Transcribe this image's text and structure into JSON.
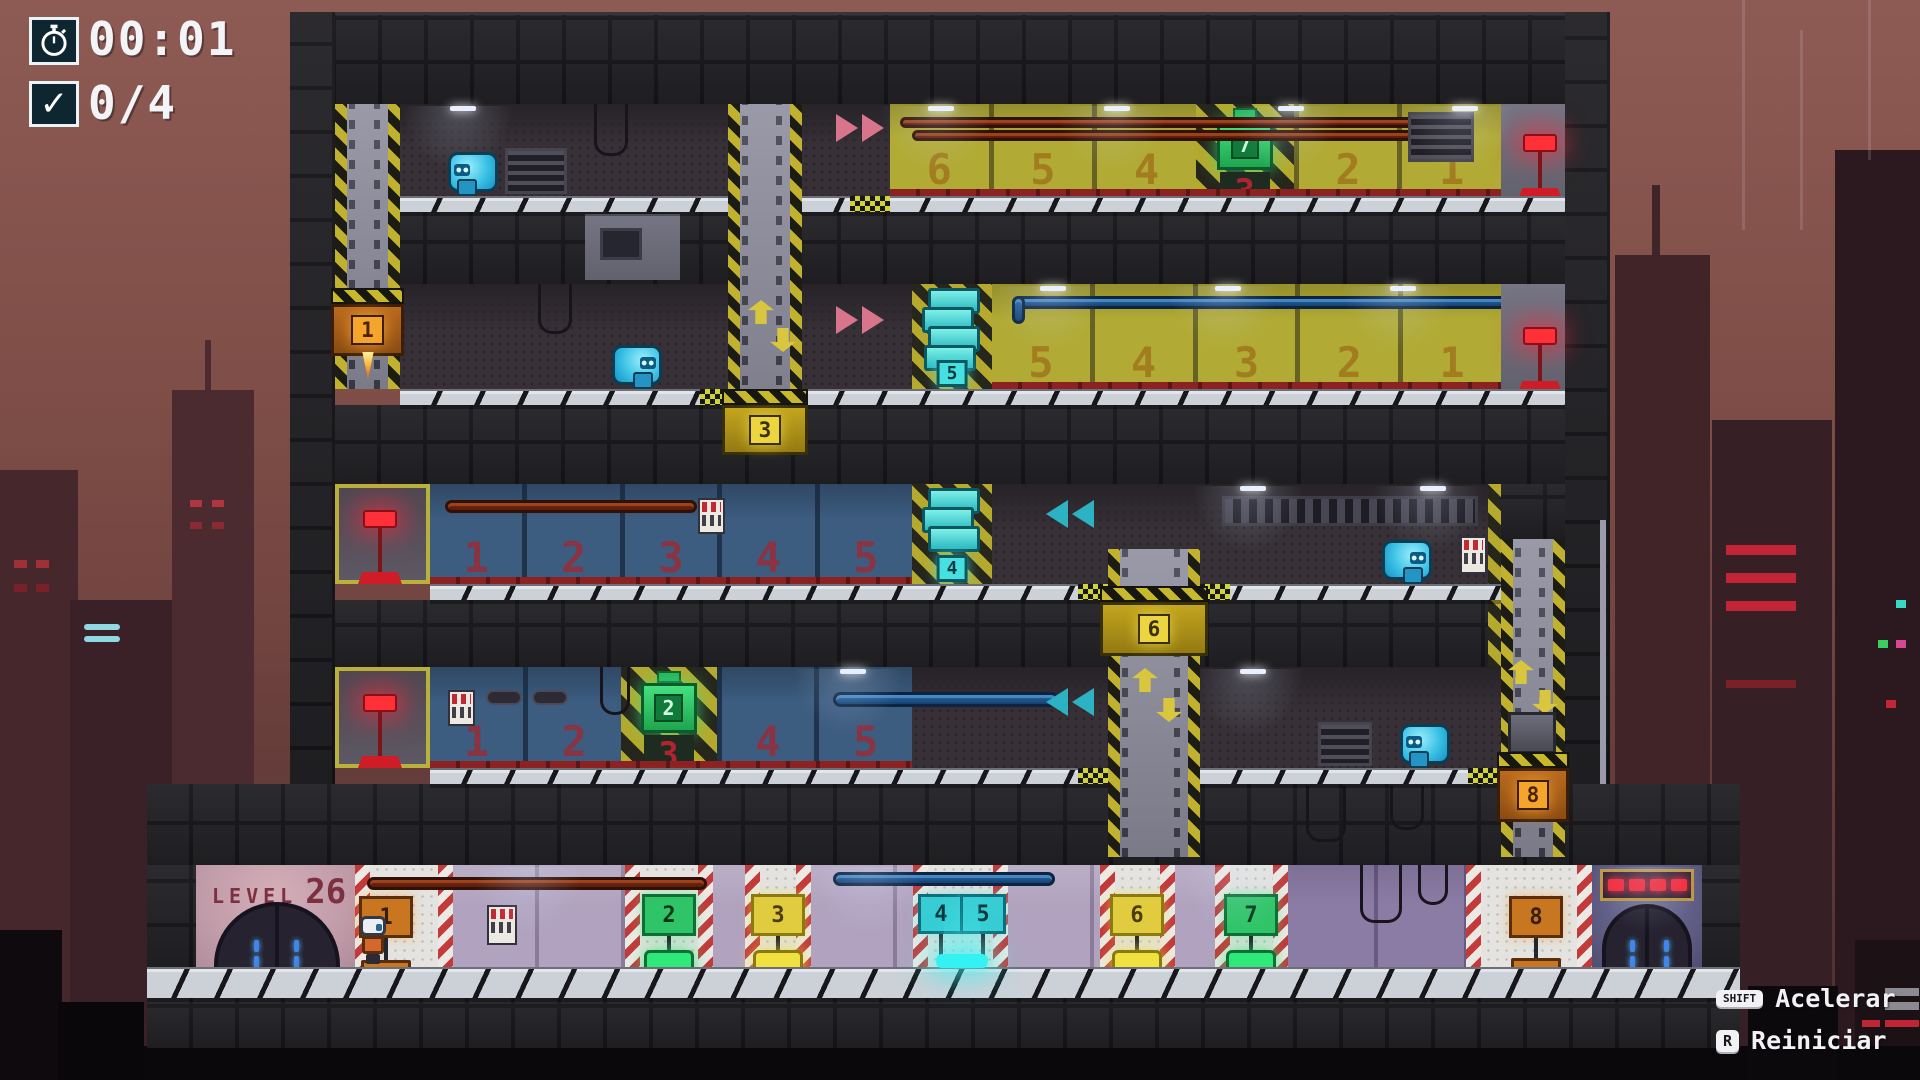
{
  "hud": {
    "timer": "00:01",
    "objective": "0/4"
  },
  "level": {
    "label": "LEVEL",
    "number": "26"
  },
  "controls": {
    "accelerate": {
      "key": "SHIFT",
      "label": "Acelerar"
    },
    "restart": {
      "key": "R",
      "label": "Reiniciar"
    }
  },
  "rooms": {
    "floor1": [
      "6",
      "5",
      "4",
      "3",
      "2",
      "1"
    ],
    "floor2": [
      "5",
      "4",
      "3",
      "2",
      "1"
    ],
    "floor3": [
      "1",
      "2",
      "3",
      "4",
      "5"
    ],
    "floor4": [
      "1",
      "2",
      "3",
      "4",
      "5"
    ]
  },
  "elevators": {
    "e1": "1",
    "e3": "3",
    "e6": "6",
    "e8": "8"
  },
  "pickups": {
    "battery_top": "7",
    "battery_bottom": "2",
    "crate_marker_upper": "5",
    "crate_marker_lower": "4"
  },
  "stations": {
    "s1": "1",
    "s2": "2",
    "s3": "3",
    "s4": "4",
    "s5": "5",
    "s6": "6",
    "s7": "7",
    "s8": "8"
  },
  "colors": {
    "accent_cyan": "#38ccd4",
    "accent_green": "#2fc468",
    "accent_yellow": "#e0cc3e",
    "accent_orange": "#c87620",
    "accent_red": "#f22838"
  }
}
